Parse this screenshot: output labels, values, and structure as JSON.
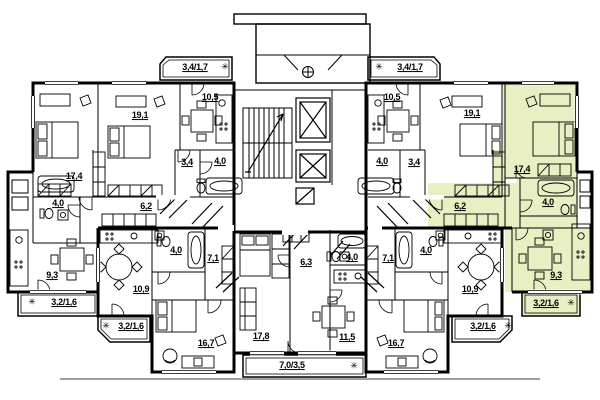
{
  "colors": {
    "highlight": "#e9efc3",
    "wall": "#000000"
  },
  "icons": {
    "snowflake": "✳"
  },
  "areas": {
    "balcony_top_left": "3,4/1,7",
    "kitchen_top_left": "10,5",
    "bedroom_191_left": "19,1",
    "hall_34_left": "3,4",
    "bath_40_top_left": "4,0",
    "bedroom_174_left": "17,4",
    "corridor_62_left": "6,2",
    "wc_40_left": "4,0",
    "kitchen_93_left": "9,3",
    "balcony_3216_left_outer": "3,2/1,6",
    "kitchen_109_left": "10,9",
    "bath_40_bottom_left": "4,0",
    "hall_71_left": "7,1",
    "bedroom_167_left": "16,7",
    "balcony_3216_left_inner": "3,2/1,6",
    "living_178": "17,8",
    "corridor_63": "6,3",
    "bath_40_center": "4,0",
    "kitchen_115": "11,5",
    "balcony_7035": "7,0/3,5",
    "balcony_top_right": "3,4/1,7",
    "kitchen_top_right": "10,5",
    "bedroom_191_right": "19,1",
    "hall_34_right": "3,4",
    "bath_40_top_right": "4,0",
    "bedroom_174_right": "17,4",
    "corridor_62_right": "6,2",
    "bath_40_right": "4,0",
    "kitchen_93_right": "9,3",
    "balcony_3216_right_outer": "3,2/1,6",
    "kitchen_109_right": "10,9",
    "bath_40_bottom_right": "4,0",
    "hall_71_right": "7,1",
    "bedroom_167_right": "16,7",
    "balcony_3216_right_inner": "3,2/1,6"
  }
}
